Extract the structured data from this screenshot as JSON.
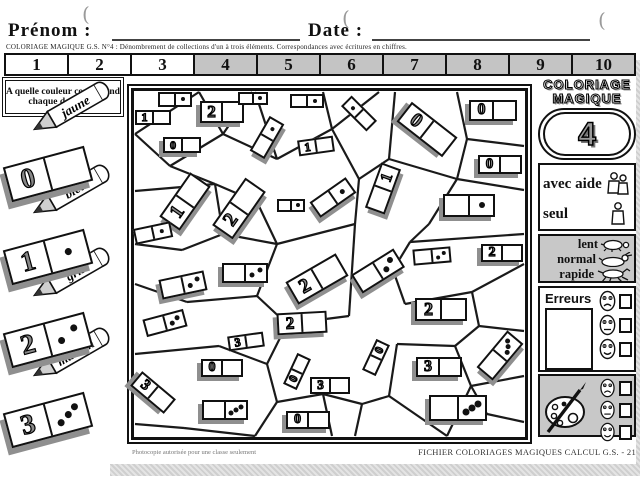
{
  "header": {
    "prenom_label": "Prénom :",
    "date_label": "Date :",
    "subtitle": "COLORIAGE MAGIQUE G.S.  N°4 : Dénombrement de collections d'un à trois éléments. Correspondances avec écritures en chiffres."
  },
  "number_strip": {
    "cells": [
      {
        "n": "1",
        "shaded": false
      },
      {
        "n": "2",
        "shaded": false
      },
      {
        "n": "3",
        "shaded": false
      },
      {
        "n": "4",
        "shaded": true
      },
      {
        "n": "5",
        "shaded": true
      },
      {
        "n": "6",
        "shaded": true
      },
      {
        "n": "7",
        "shaded": true
      },
      {
        "n": "8",
        "shaded": true
      },
      {
        "n": "9",
        "shaded": true
      },
      {
        "n": "10",
        "shaded": true
      }
    ]
  },
  "legend": {
    "question": "A quelle couleur correspond chaque domino ?",
    "items": [
      {
        "digit": "0",
        "dots": 0,
        "color_label": "jaune"
      },
      {
        "digit": "1",
        "dots": 1,
        "color_label": "bleu"
      },
      {
        "digit": "2",
        "dots": 2,
        "color_label": "gris"
      },
      {
        "digit": "3",
        "dots": 3,
        "color_label": "marron"
      }
    ]
  },
  "puzzle": {
    "dominoes": [
      {
        "x": 41,
        "y": 8,
        "w": 34,
        "h": 15,
        "rot": 0,
        "shadow": false,
        "sym": "d1",
        "side": "right"
      },
      {
        "x": 19,
        "y": 26,
        "w": 36,
        "h": 15,
        "rot": 0,
        "shadow": false,
        "sym": "1",
        "side": "left"
      },
      {
        "x": 88,
        "y": 21,
        "w": 44,
        "h": 22,
        "rot": 0,
        "shadow": true,
        "sym": "2",
        "side": "left"
      },
      {
        "x": 119,
        "y": 7,
        "w": 30,
        "h": 13,
        "rot": 0,
        "shadow": false,
        "sym": "d1",
        "side": "right"
      },
      {
        "x": 48,
        "y": 54,
        "w": 38,
        "h": 16,
        "rot": 0,
        "shadow": true,
        "sym": "0",
        "side": "left"
      },
      {
        "x": 133,
        "y": 46,
        "w": 40,
        "h": 17,
        "rot": -60,
        "shadow": true,
        "sym": "d1",
        "side": "right"
      },
      {
        "x": 173,
        "y": 10,
        "w": 34,
        "h": 14,
        "rot": 0,
        "shadow": false,
        "sym": "d1",
        "side": "right"
      },
      {
        "x": 225,
        "y": 22,
        "w": 36,
        "h": 15,
        "rot": 45,
        "shadow": false,
        "sym": "d1",
        "side": "left"
      },
      {
        "x": 293,
        "y": 38,
        "w": 58,
        "h": 25,
        "rot": 38,
        "shadow": true,
        "sym": "0",
        "side": "left"
      },
      {
        "x": 359,
        "y": 19,
        "w": 48,
        "h": 21,
        "rot": 0,
        "shadow": true,
        "sym": "0",
        "side": "left"
      },
      {
        "x": 182,
        "y": 55,
        "w": 36,
        "h": 16,
        "rot": -8,
        "shadow": false,
        "sym": "1",
        "side": "left"
      },
      {
        "x": 366,
        "y": 73,
        "w": 44,
        "h": 19,
        "rot": 0,
        "shadow": true,
        "sym": "0",
        "side": "left"
      },
      {
        "x": 51,
        "y": 110,
        "w": 54,
        "h": 25,
        "rot": -55,
        "shadow": true,
        "sym": "1",
        "side": "left"
      },
      {
        "x": 105,
        "y": 117,
        "w": 58,
        "h": 25,
        "rot": -55,
        "shadow": true,
        "sym": "2",
        "side": "left"
      },
      {
        "x": 19,
        "y": 142,
        "w": 38,
        "h": 16,
        "rot": -12,
        "shadow": false,
        "sym": "d1",
        "side": "right"
      },
      {
        "x": 157,
        "y": 114,
        "w": 28,
        "h": 13,
        "rot": 0,
        "shadow": false,
        "sym": "d1",
        "side": "right"
      },
      {
        "x": 199,
        "y": 106,
        "w": 44,
        "h": 19,
        "rot": -35,
        "shadow": true,
        "sym": "d1",
        "side": "right"
      },
      {
        "x": 249,
        "y": 97,
        "w": 48,
        "h": 21,
        "rot": -70,
        "shadow": true,
        "sym": "1",
        "side": "right"
      },
      {
        "x": 335,
        "y": 114,
        "w": 52,
        "h": 23,
        "rot": 0,
        "shadow": true,
        "sym": "d1",
        "side": "right"
      },
      {
        "x": 368,
        "y": 162,
        "w": 42,
        "h": 18,
        "rot": 0,
        "shadow": true,
        "sym": "2",
        "side": "left"
      },
      {
        "x": 298,
        "y": 165,
        "w": 38,
        "h": 16,
        "rot": -5,
        "shadow": false,
        "sym": "d2",
        "side": "right"
      },
      {
        "x": 111,
        "y": 182,
        "w": 46,
        "h": 20,
        "rot": 0,
        "shadow": true,
        "sym": "d2",
        "side": "right"
      },
      {
        "x": 49,
        "y": 194,
        "w": 46,
        "h": 20,
        "rot": -12,
        "shadow": true,
        "sym": "d2",
        "side": "right"
      },
      {
        "x": 183,
        "y": 188,
        "w": 58,
        "h": 26,
        "rot": -30,
        "shadow": true,
        "sym": "2",
        "side": "left"
      },
      {
        "x": 244,
        "y": 180,
        "w": 50,
        "h": 22,
        "rot": -32,
        "shadow": true,
        "sym": "d2",
        "side": "right"
      },
      {
        "x": 31,
        "y": 232,
        "w": 42,
        "h": 18,
        "rot": -15,
        "shadow": false,
        "sym": "d2",
        "side": "right"
      },
      {
        "x": 168,
        "y": 232,
        "w": 50,
        "h": 22,
        "rot": -3,
        "shadow": true,
        "sym": "2",
        "side": "left"
      },
      {
        "x": 307,
        "y": 218,
        "w": 52,
        "h": 23,
        "rot": 0,
        "shadow": true,
        "sym": "2",
        "side": "left"
      },
      {
        "x": 112,
        "y": 250,
        "w": 36,
        "h": 15,
        "rot": -8,
        "shadow": false,
        "sym": "3",
        "side": "left"
      },
      {
        "x": 19,
        "y": 301,
        "w": 44,
        "h": 19,
        "rot": 40,
        "shadow": true,
        "sym": "3",
        "side": "left"
      },
      {
        "x": 88,
        "y": 277,
        "w": 42,
        "h": 18,
        "rot": 0,
        "shadow": true,
        "sym": "0",
        "side": "left"
      },
      {
        "x": 91,
        "y": 319,
        "w": 46,
        "h": 20,
        "rot": 0,
        "shadow": true,
        "sym": "d3",
        "side": "right"
      },
      {
        "x": 163,
        "y": 280,
        "w": 34,
        "h": 15,
        "rot": -65,
        "shadow": false,
        "sym": "0",
        "side": "left"
      },
      {
        "x": 196,
        "y": 294,
        "w": 40,
        "h": 17,
        "rot": 0,
        "shadow": false,
        "sym": "3",
        "side": "left"
      },
      {
        "x": 174,
        "y": 329,
        "w": 44,
        "h": 18,
        "rot": 0,
        "shadow": true,
        "sym": "0",
        "side": "left"
      },
      {
        "x": 242,
        "y": 266,
        "w": 34,
        "h": 15,
        "rot": -65,
        "shadow": false,
        "sym": "0",
        "side": "right"
      },
      {
        "x": 305,
        "y": 276,
        "w": 46,
        "h": 20,
        "rot": 0,
        "shadow": true,
        "sym": "3",
        "side": "left"
      },
      {
        "x": 366,
        "y": 264,
        "w": 48,
        "h": 21,
        "rot": -50,
        "shadow": true,
        "sym": "d3",
        "side": "right"
      },
      {
        "x": 324,
        "y": 317,
        "w": 58,
        "h": 26,
        "rot": 0,
        "shadow": true,
        "sym": "d3",
        "side": "right"
      }
    ],
    "mesh": [
      [
        1,
        43,
        65,
        1
      ],
      [
        65,
        1,
        89,
        43
      ],
      [
        1,
        43,
        36,
        75
      ],
      [
        36,
        75,
        89,
        43
      ],
      [
        89,
        43,
        118,
        1
      ],
      [
        89,
        43,
        143,
        68
      ],
      [
        143,
        68,
        121,
        1
      ],
      [
        143,
        68,
        198,
        38
      ],
      [
        198,
        38,
        189,
        1
      ],
      [
        198,
        38,
        245,
        1
      ],
      [
        198,
        38,
        225,
        88
      ],
      [
        225,
        88,
        221,
        133
      ],
      [
        225,
        88,
        255,
        68
      ],
      [
        255,
        68,
        261,
        1
      ],
      [
        255,
        68,
        323,
        88
      ],
      [
        323,
        88,
        333,
        48
      ],
      [
        333,
        48,
        323,
        1
      ],
      [
        333,
        48,
        390,
        55
      ],
      [
        323,
        88,
        390,
        99
      ],
      [
        323,
        88,
        295,
        133
      ],
      [
        295,
        133,
        276,
        151
      ],
      [
        276,
        151,
        390,
        143
      ],
      [
        276,
        151,
        259,
        179
      ],
      [
        259,
        179,
        271,
        213
      ],
      [
        271,
        213,
        338,
        201
      ],
      [
        338,
        201,
        390,
        173
      ],
      [
        338,
        201,
        345,
        235
      ],
      [
        345,
        235,
        390,
        240
      ],
      [
        345,
        235,
        321,
        255
      ],
      [
        321,
        255,
        337,
        295
      ],
      [
        337,
        295,
        390,
        285
      ],
      [
        337,
        295,
        313,
        345
      ],
      [
        321,
        255,
        263,
        253
      ],
      [
        263,
        253,
        255,
        305
      ],
      [
        255,
        305,
        313,
        345
      ],
      [
        255,
        305,
        228,
        313
      ],
      [
        228,
        313,
        221,
        345
      ],
      [
        228,
        313,
        189,
        303
      ],
      [
        189,
        303,
        143,
        311
      ],
      [
        143,
        311,
        121,
        345
      ],
      [
        143,
        311,
        133,
        273
      ],
      [
        133,
        273,
        85,
        255
      ],
      [
        85,
        255,
        1,
        263
      ],
      [
        133,
        273,
        153,
        233
      ],
      [
        153,
        233,
        123,
        205
      ],
      [
        123,
        205,
        53,
        211
      ],
      [
        53,
        211,
        1,
        193
      ],
      [
        123,
        205,
        143,
        153
      ],
      [
        143,
        153,
        89,
        143
      ],
      [
        89,
        143,
        48,
        159
      ],
      [
        48,
        159,
        1,
        153
      ],
      [
        89,
        143,
        81,
        93
      ],
      [
        81,
        93,
        36,
        75
      ],
      [
        143,
        153,
        221,
        133
      ],
      [
        153,
        233,
        215,
        225
      ],
      [
        215,
        225,
        221,
        133
      ],
      [
        81,
        93,
        123,
        111
      ],
      [
        123,
        111,
        143,
        153
      ],
      [
        189,
        303,
        198,
        345
      ],
      [
        337,
        295,
        353,
        323
      ],
      [
        353,
        323,
        390,
        331
      ],
      [
        1,
        100,
        48,
        96
      ],
      [
        48,
        96,
        81,
        93
      ],
      [
        1,
        333,
        50,
        337
      ],
      [
        50,
        337,
        121,
        345
      ]
    ]
  },
  "sidebar": {
    "title_line1": "COLORIAGE",
    "title_line2": "MAGIQUE",
    "number": "4",
    "mode": {
      "with_help": "avec aide",
      "alone": "seul"
    },
    "speed": {
      "slow": "lent",
      "normal": "normal",
      "fast": "rapide"
    },
    "errors_label": "Erreurs",
    "faces": [
      "sad",
      "neutral",
      "happy"
    ]
  },
  "footer": {
    "copyright": "© MDI 1997",
    "photocopy": "Photocopie autorisée pour une classe seulement",
    "fichier": "FICHIER COLORIAGES MAGIQUES CALCUL G.S.  -  21"
  },
  "colors": {
    "shade": "#c8c8c8",
    "line": "#1a1a1a",
    "domino_shadow": "#8f8f8f"
  }
}
